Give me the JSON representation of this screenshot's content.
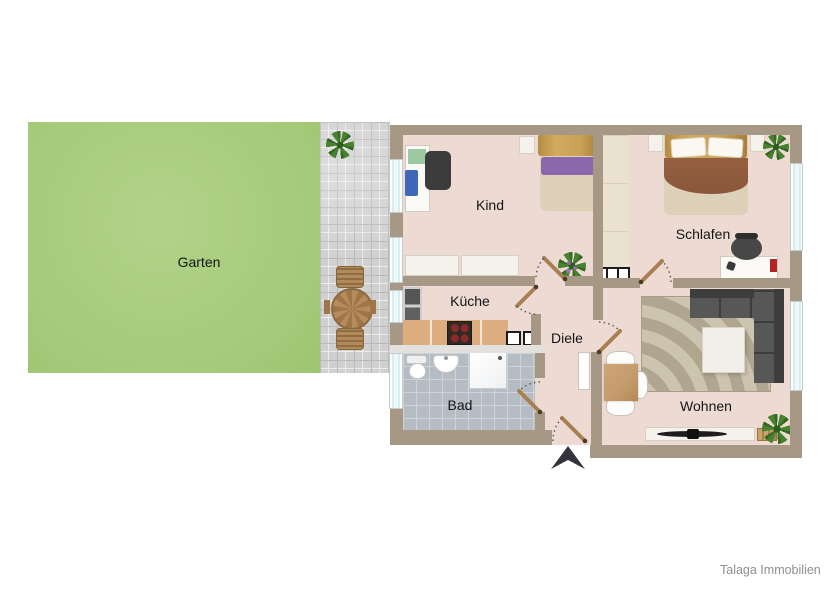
{
  "rooms": {
    "garten": {
      "label": "Garten"
    },
    "kind": {
      "label": "Kind"
    },
    "schlafen": {
      "label": "Schlafen"
    },
    "kueche": {
      "label": "Küche"
    },
    "diele": {
      "label": "Diele"
    },
    "bad": {
      "label": "Bad"
    },
    "wohnen": {
      "label": "Wohnen"
    }
  },
  "footer": {
    "brand": "Talaga Immobilien"
  },
  "colors": {
    "garden_green": "#a5ca7a",
    "patio_gray": "#d0d0d0",
    "wall_taupe": "#a69884",
    "floor_pink_beige": "#eddbd3",
    "bath_tile_gray": "#b5bcc3",
    "kitchen_counter_tan": "#dcae7f",
    "sofa_dark_gray": "#4d4d4d",
    "window_glass_blue": "#d8edf0",
    "bed_blanket_brown": "#8a573c",
    "pillow_purple": "#8b68ac",
    "door_wood": "#a87f52"
  }
}
